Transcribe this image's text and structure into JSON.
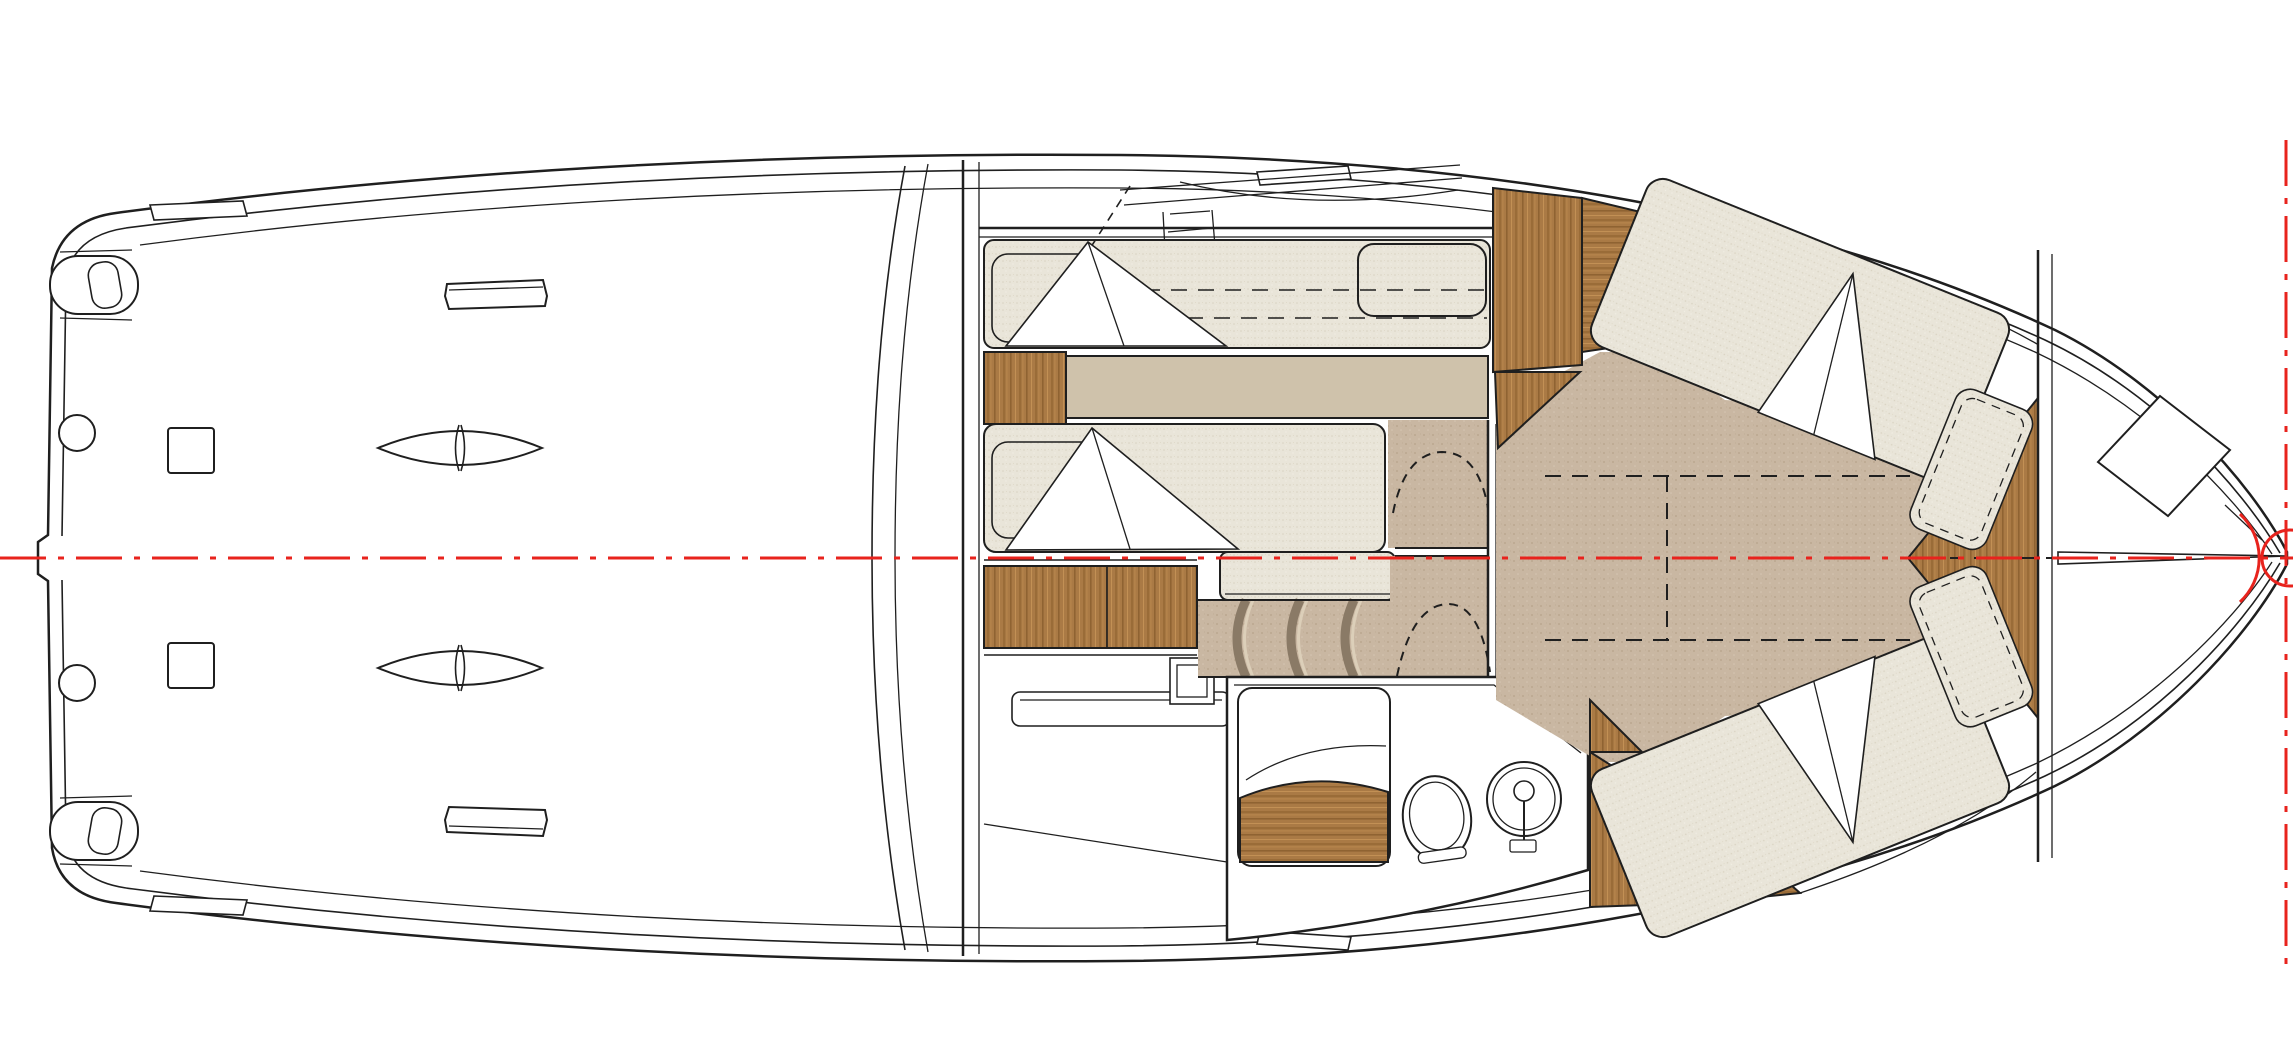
{
  "meta": {
    "title": "Motor yacht lower-deck floor plan",
    "type": "technical-drawing",
    "view": "top-down plan",
    "canvas": {
      "width": 2293,
      "height": 1043
    }
  },
  "colors": {
    "line": "#1f1f1f",
    "paper": "#ffffff",
    "fabric_base": "#e9e5d9",
    "fabric_dot_dark": "#d9d3c2",
    "fabric_dot_light": "#f1eee4",
    "floor_base": "#c9b7a2",
    "floor_dot_dark": "#b7a28a",
    "floor_dot_light": "#d6c6b2",
    "platform": "#cfc2ab",
    "step_edge": "#8a7a66",
    "step_highlight": "#dccfb9",
    "wood_base": "#aa7a45",
    "wood_dark": "#8f6332",
    "wood_light": "#c29055",
    "red": "#e8231d"
  },
  "annotations": {
    "centerline": {
      "id": "hull-centerline",
      "style": "dash-dot",
      "color": "#e8231d",
      "orientation": "horizontal"
    },
    "bow_station_line": {
      "id": "bow-station-line",
      "style": "dash-dot",
      "color": "#e8231d",
      "orientation": "vertical"
    },
    "bow_marker": {
      "id": "bow-roller-marker",
      "shape": "circle-and-arc",
      "color": "#e8231d"
    },
    "keel_dashes": {
      "id": "bow-keel-dashes",
      "style": "dashed",
      "color": "#1f1f1f"
    }
  },
  "regions": [
    {
      "id": "swim-platform",
      "label": "stern swim platform & cockpit deck"
    },
    {
      "id": "mid-cabin",
      "label": "mid cabin with twin berths"
    },
    {
      "id": "galley-console",
      "label": "galley console / stowage"
    },
    {
      "id": "companionway-stairs",
      "label": "curved companionway steps"
    },
    {
      "id": "corridor",
      "label": "lower lobby & door openings"
    },
    {
      "id": "wet-head",
      "label": "bathroom with shower, toilet, sink"
    },
    {
      "id": "wardrobe",
      "label": "teak wardrobe panels"
    },
    {
      "id": "bow-cabin",
      "label": "forward V-berth cabin"
    },
    {
      "id": "foredeck",
      "label": "foredeck / anchor locker"
    }
  ],
  "fixtures": {
    "cockpit": [
      "mooring-cleat x2",
      "deck-drain x2",
      "deck-hatch x2",
      "step-pad x2",
      "stern-pod x2",
      "gunwale-pad x4",
      "windshield",
      "aft-bulkhead"
    ],
    "mid_cabin": [
      "single-berth x2",
      "pillow x2",
      "folded-blanket x2",
      "nightstand",
      "berth-platform",
      "backrest-cushion",
      "drawer-bank",
      "seat-cushion-extension",
      "overhead-hatch-dashes"
    ],
    "wet_head": [
      "shower-enclosure",
      "teak-shower-bench",
      "toilet",
      "round-sink",
      "faucet"
    ],
    "bow_cabin": [
      "v-berth x2",
      "pillow x2",
      "folded-blanket x2",
      "infill-cushion-dashes",
      "teak-bow-wedge",
      "forward-bulkhead",
      "wardrobe-panel x3",
      "aft-teak-panel x2",
      "door-swing-arc x3"
    ],
    "foredeck": [
      "anchor-locker-hatch",
      "bow-sprit-line"
    ]
  }
}
